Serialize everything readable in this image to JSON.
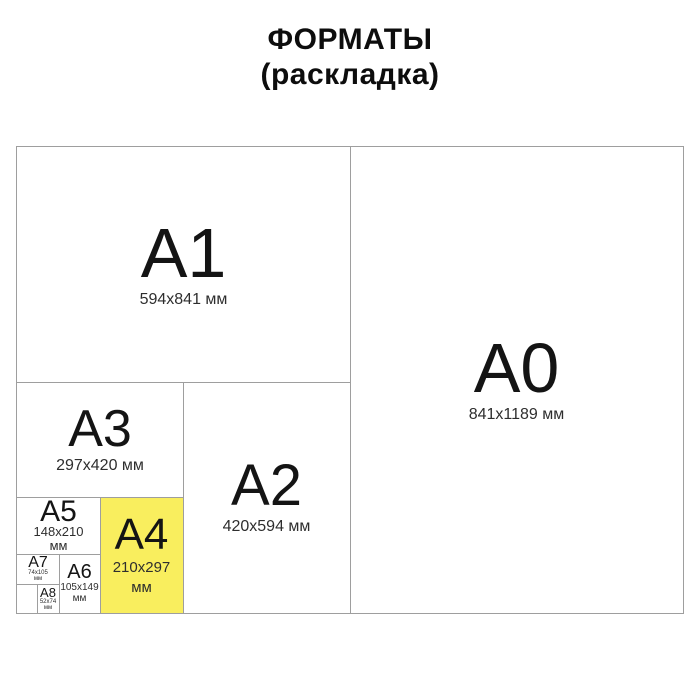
{
  "title": {
    "line1": "ФОРМАТЫ",
    "line2": "(раскладка)"
  },
  "formats": {
    "a0": {
      "label": "A0",
      "dims": "841x1189 мм"
    },
    "a1": {
      "label": "A1",
      "dims": "594x841 мм"
    },
    "a2": {
      "label": "A2",
      "dims": "420x594 мм"
    },
    "a3": {
      "label": "A3",
      "dims": "297x420 мм"
    },
    "a4": {
      "label": "A4",
      "dims_line1": "210x297",
      "dims_line2": "мм",
      "highlighted": true
    },
    "a5": {
      "label": "A5",
      "dims_line1": "148x210",
      "dims_line2": "мм"
    },
    "a6": {
      "label": "A6",
      "dims_line1": "105x149",
      "dims_line2": "мм"
    },
    "a7": {
      "label": "A7",
      "dims_line1": "74x105",
      "dims_line2": "мм"
    },
    "a8": {
      "label": "A8",
      "dims_line1": "52x74",
      "dims_line2": "мм"
    }
  },
  "colors": {
    "highlight_yellow": "#f9ee5e",
    "border_gray": "#9e9e9e",
    "text_black": "#111111"
  }
}
